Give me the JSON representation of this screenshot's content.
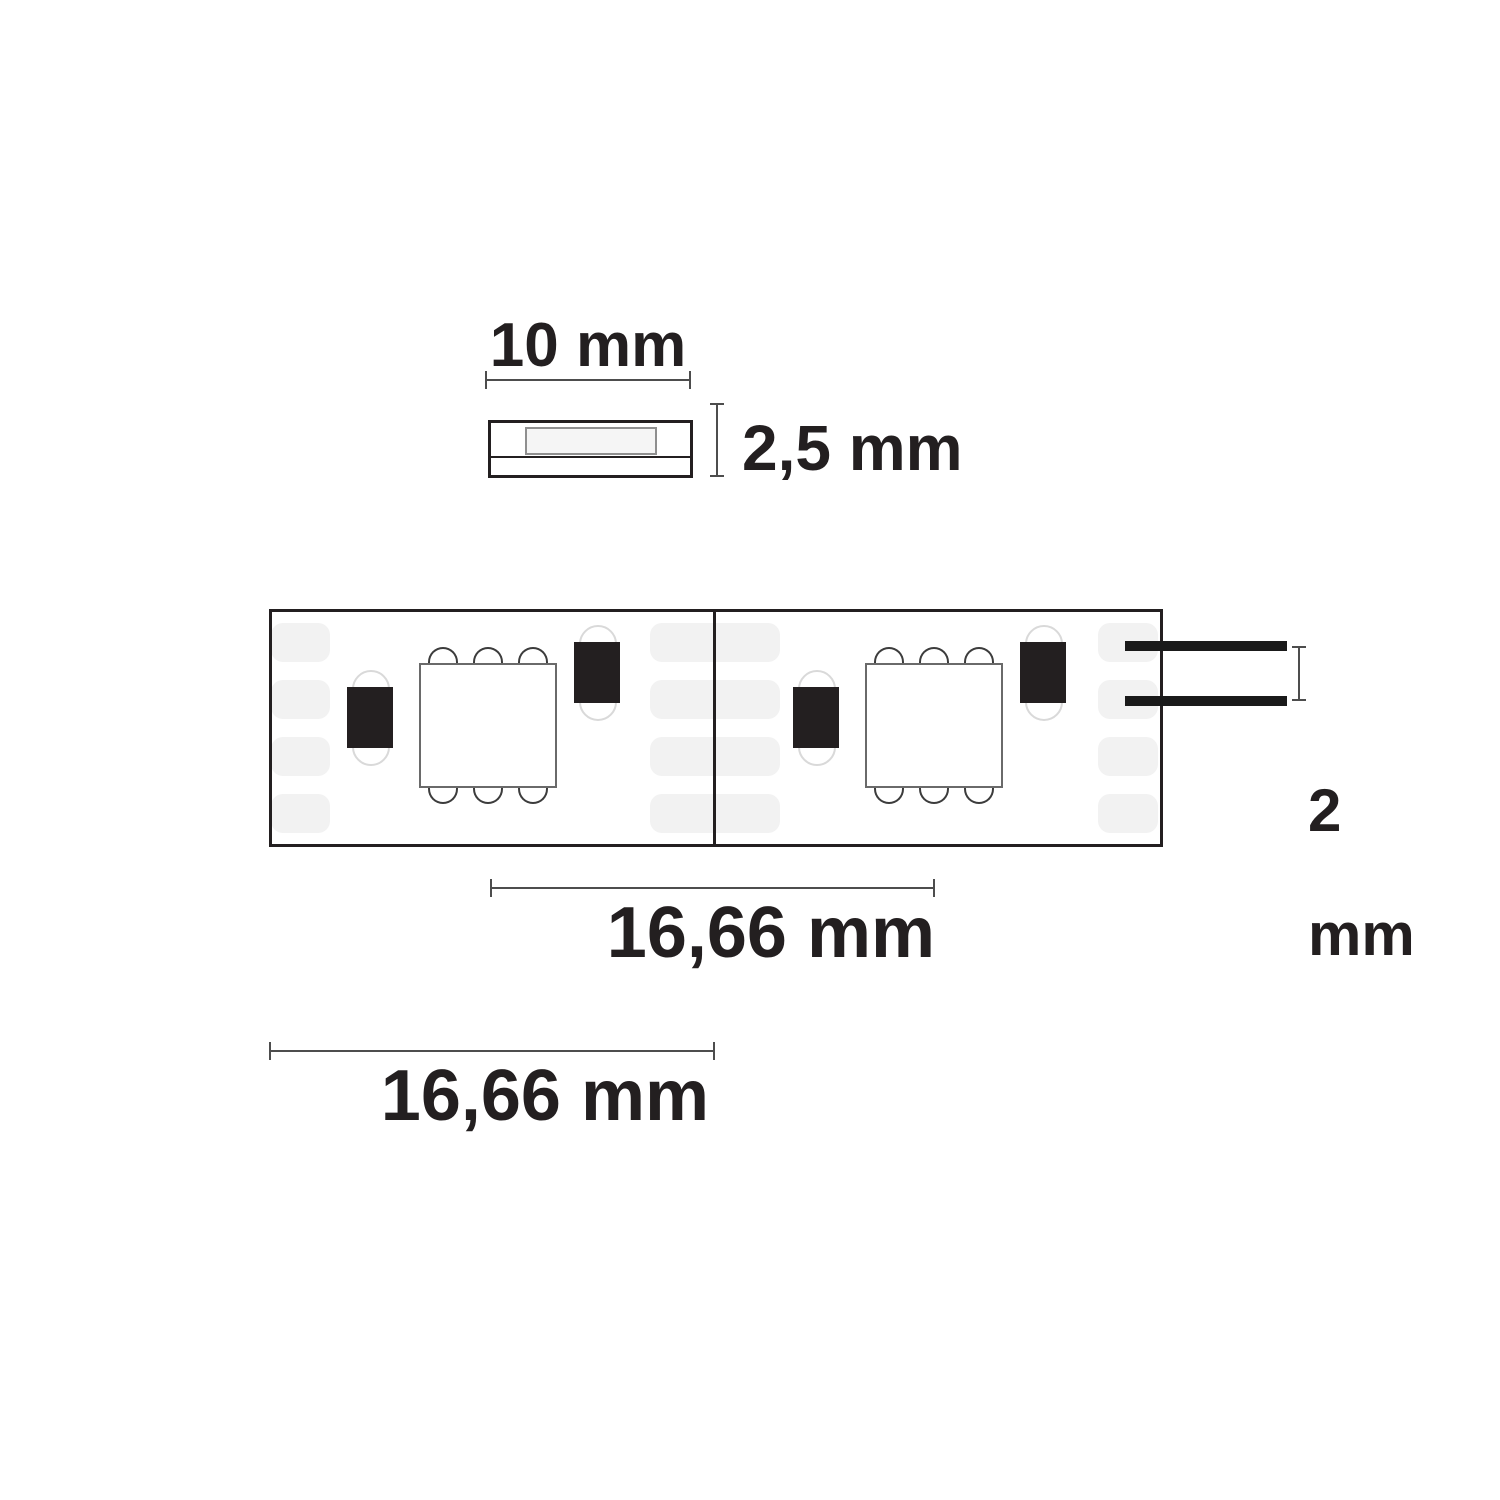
{
  "figure": {
    "type": "technical-dimension-diagram",
    "subject": "LED flex strip with two segments, SMD components and connection wires",
    "segment_count": 2,
    "solder_pad_rows": 4
  },
  "dimensions": {
    "strip_width": "10 mm",
    "strip_height": "2,5 mm",
    "wire_pitch_value": "2",
    "wire_pitch_unit": "mm",
    "led_pitch": "16,66 mm",
    "segment_length": "16,66 mm"
  },
  "colors": {
    "background": "#ffffff",
    "ink": "#231f20",
    "dimension_line": "#4d4d4d",
    "solder_pad_fill": "#f2f2f2",
    "chip_outline": "#6a6a6a",
    "stadium_outline": "#d9d9d9",
    "cross_section_inner_fill": "#f5f5f5"
  }
}
